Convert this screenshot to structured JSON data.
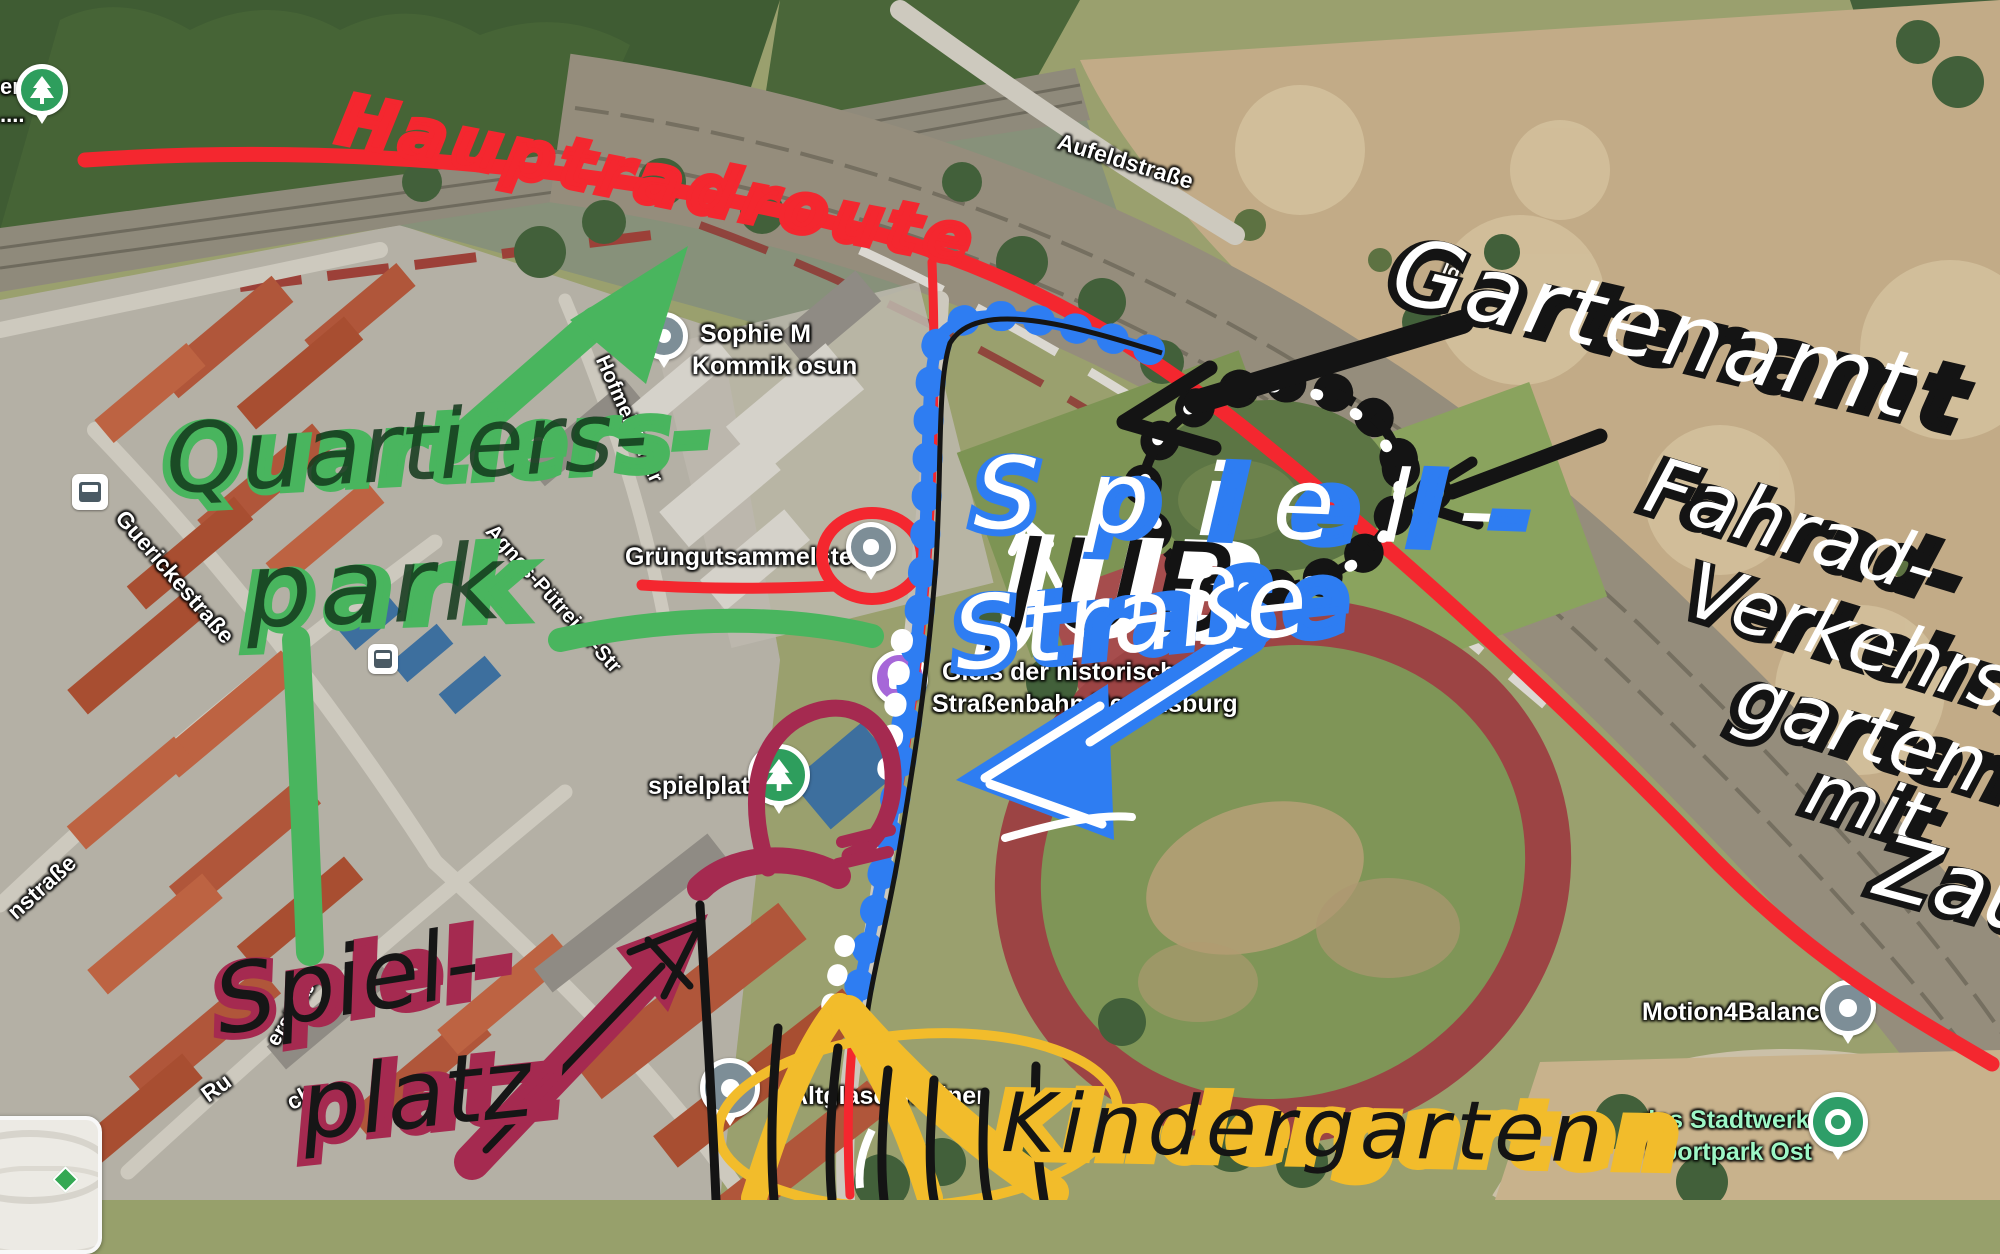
{
  "map_labels": {
    "aufeldstrasse": "Aufeldstraße",
    "sophie_line1": "Sophie M",
    "sophie_line2": "Kommik osun",
    "hofmeister": "Hofmeisterstr",
    "agnes": "Agnes-Pütreich-Str",
    "guericke": "Guerickestraße",
    "gruengut": "Grüngutsammelstelle",
    "gleis_line1": "Gleis der historischen",
    "gleis_line2": "Straßenbahn Regensburg",
    "spielplatz": "spielplatz",
    "nstrasse": "nstraße",
    "erstrasse": "erstraße",
    "ru_fragment": "Ru",
    "ch_fragment": "ch",
    "ld_fragment": "ld",
    "er_fragment": "er",
    "dots_fragment": "....",
    "motion": "Motion4Balance",
    "stadtwerk_line1": "das Stadtwerk.",
    "stadtwerk_line2": "Sportpark Ost",
    "altglas": "Altglascontainer"
  },
  "icons": {
    "museum_badge": "M"
  },
  "annotations": {
    "hauptradroute": "Hauptradroute",
    "quartiers": "Quartiers-",
    "park": "park",
    "spiel_maroon": "Spiel-",
    "platz_maroon": "platz",
    "jub": "JUB",
    "spiel_blue": "Spiel-",
    "strasse_blue": "Straße",
    "gartenamt": "Gartenamt",
    "fahrrad_line1": "Fahrad-",
    "fahrrad_line2": "Verkehrs",
    "fahrrad_line3": "garten",
    "fahrrad_line4": "mit",
    "fahrrad_line5": "Zau",
    "kindergarten": "Kindergarten"
  },
  "colors": {
    "route_red": "#f4272f",
    "annotation_green": "#49b55e",
    "annotation_maroon": "#a52a50",
    "annotation_blue": "#2e7df2",
    "annotation_yellow": "#f2bc2b",
    "annotation_black": "#141414",
    "annotation_white": "#ffffff",
    "stadtwerk_green": "#9ef7c6",
    "pin_gray": "#7d8e97",
    "pin_green": "#2e9e5d",
    "pin_purple": "#a667d8"
  }
}
